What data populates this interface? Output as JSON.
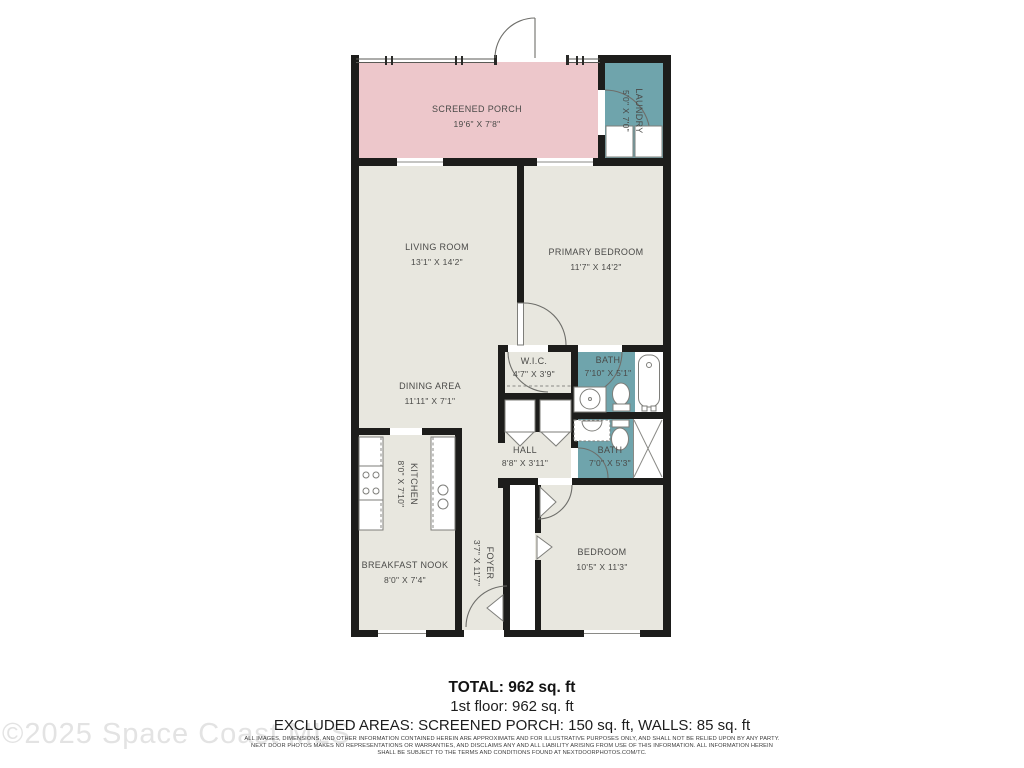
{
  "plan": {
    "rooms": [
      {
        "id": "screened-porch",
        "name": "SCREENED PORCH",
        "dims": "19'6\" X 7'8\""
      },
      {
        "id": "laundry",
        "name": "LAUNDRY",
        "dims": "5'0\" X 7'0\""
      },
      {
        "id": "living-room",
        "name": "LIVING ROOM",
        "dims": "13'1\" X 14'2\""
      },
      {
        "id": "primary-bedroom",
        "name": "PRIMARY BEDROOM",
        "dims": "11'7\" X 14'2\""
      },
      {
        "id": "wic",
        "name": "W.I.C.",
        "dims": "4'7\" X 3'9\""
      },
      {
        "id": "bath-1",
        "name": "BATH",
        "dims": "7'10\" X 5'1\""
      },
      {
        "id": "dining-area",
        "name": "DINING AREA",
        "dims": "11'11\" X 7'1\""
      },
      {
        "id": "hall",
        "name": "HALL",
        "dims": "8'8\" X 3'11\""
      },
      {
        "id": "bath-2",
        "name": "BATH",
        "dims": "7'0\" X 5'3\""
      },
      {
        "id": "kitchen",
        "name": "KITCHEN",
        "dims": "8'0\" X 7'10\""
      },
      {
        "id": "breakfast-nook",
        "name": "BREAKFAST NOOK",
        "dims": "8'0\" X 7'4\""
      },
      {
        "id": "foyer",
        "name": "FOYER",
        "dims": "3'7\" X 11'7\""
      },
      {
        "id": "bedroom",
        "name": "BEDROOM",
        "dims": "10'5\" X 11'3\""
      }
    ],
    "colors": {
      "wall": "#1d1d1b",
      "room": "#e8e7df",
      "wet_area": "#6fa4ac",
      "porch": "#edc7cb",
      "label": "#4a4a48"
    }
  },
  "summary": {
    "total": "TOTAL: 962 sq. ft",
    "floor": "1st floor: 962 sq. ft",
    "excluded": "EXCLUDED AREAS: SCREENED PORCH: 150 sq. ft, WALLS: 85 sq. ft"
  },
  "disclaimer": {
    "line1": "ALL IMAGES, DIMENSIONS, AND OTHER INFORMATION CONTAINED HEREIN ARE APPROXIMATE AND FOR ILLUSTRATIVE PURPOSES ONLY, AND SHALL NOT BE RELIED UPON BY ANY PARTY.",
    "line2": "NEXT DOOR PHOTOS MAKES NO REPRESENTATIONS OR WARRANTIES, AND DISCLAIMS ANY AND ALL LIABILITY ARISING FROM USE OF THIS INFORMATION. ALL INFORMATION HEREIN",
    "line3": "SHALL BE SUBJECT TO THE TERMS AND CONDITIONS FOUND AT NEXTDOORPHOTOS.COM/TC."
  },
  "watermark": "©2025 Space Coast MLS"
}
